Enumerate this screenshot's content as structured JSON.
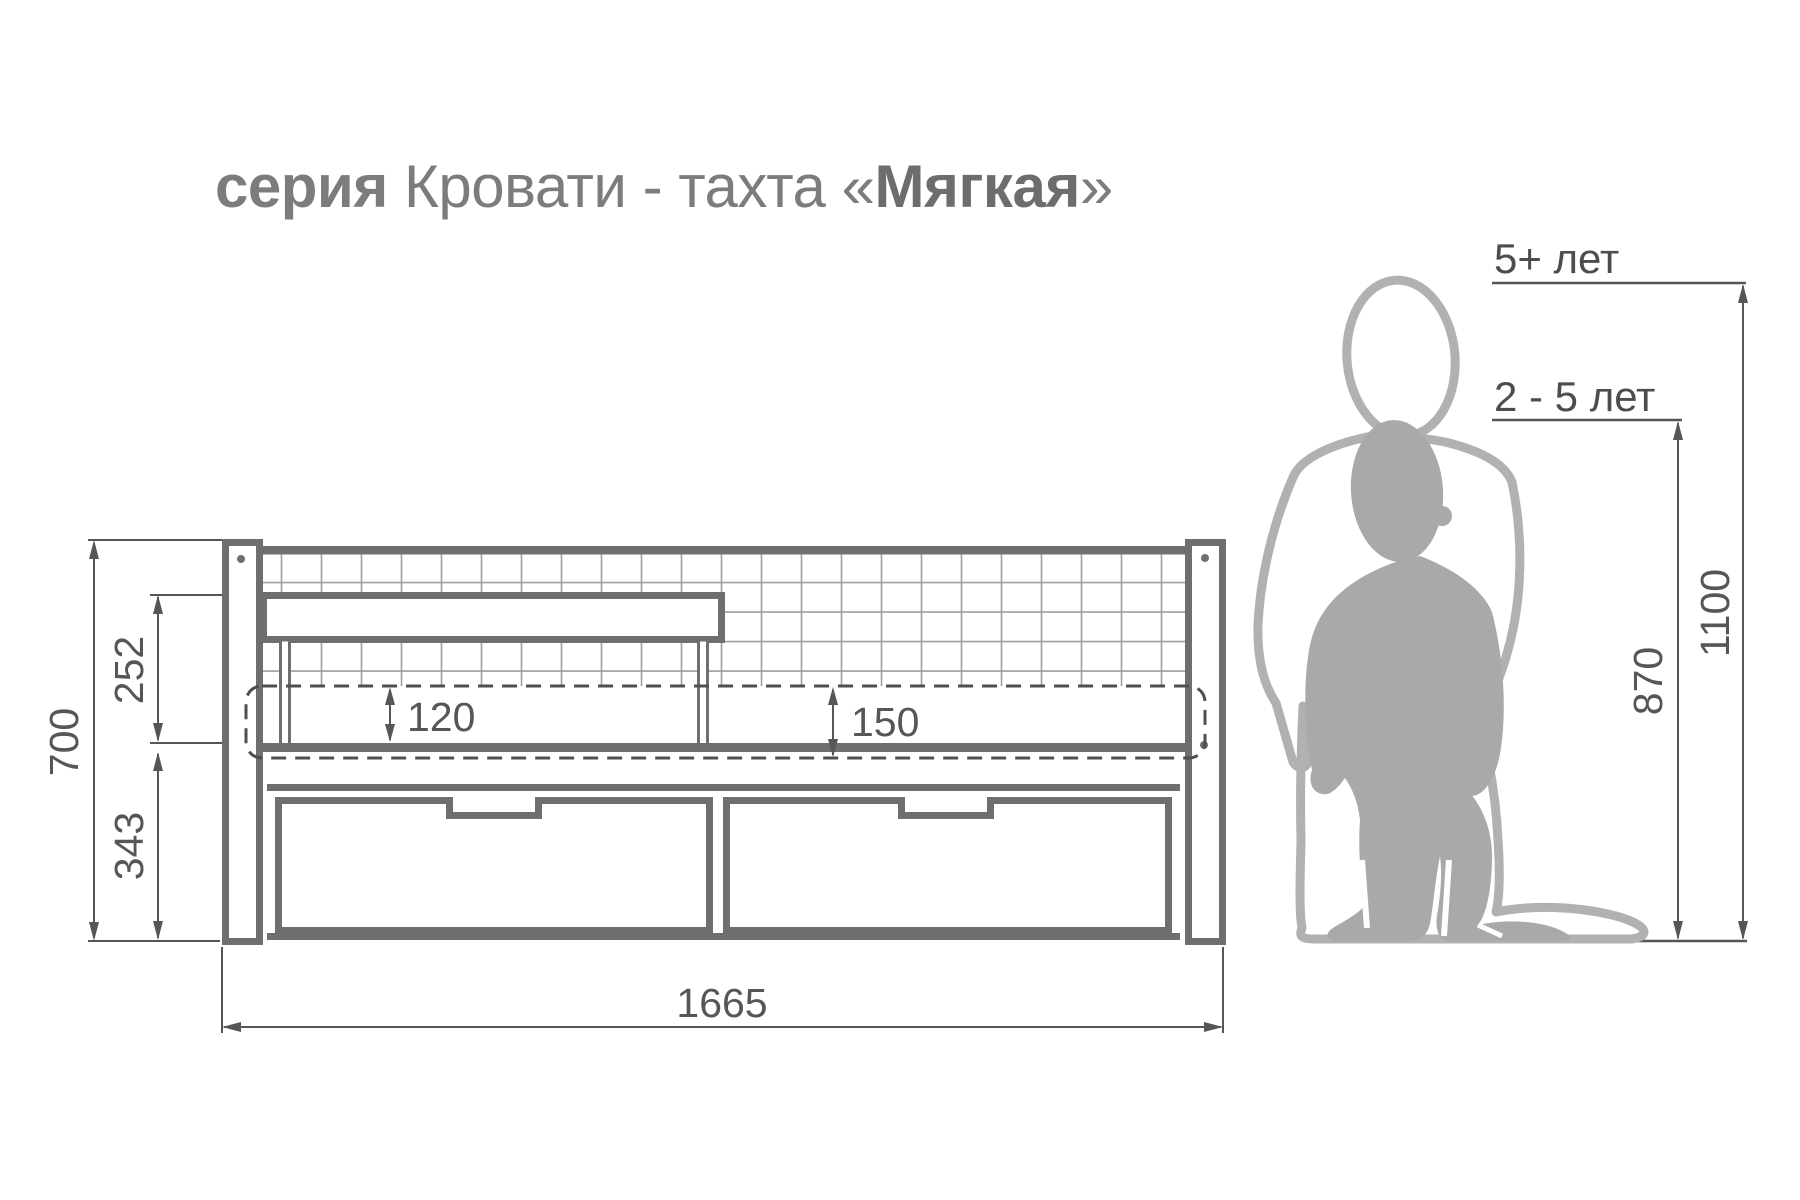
{
  "title": {
    "prefix": "серия",
    "series_name": "Кровати - тахта",
    "quote_open": "«",
    "product_name": "Мягкая",
    "quote_close": "»"
  },
  "dimensions": {
    "total_height": "700",
    "backrest_height": "252",
    "under_seat_height": "343",
    "mattress_above_frame": "120",
    "mattress_thickness": "150",
    "total_length": "1665",
    "child_older_height": "1100",
    "child_younger_height": "870"
  },
  "age_labels": {
    "older": "5+ лет",
    "younger": "2 - 5 лет"
  },
  "colors": {
    "frame": "#6f6f6f",
    "grid": "#9e9e9e",
    "dimension": "#565656",
    "title_gray": "#7c7c7c",
    "title_bold": "#6d6d6d",
    "silhouette_solid": "#a9a9a9",
    "silhouette_outline": "#b1b1b1",
    "age_text": "#4d4d4d"
  }
}
